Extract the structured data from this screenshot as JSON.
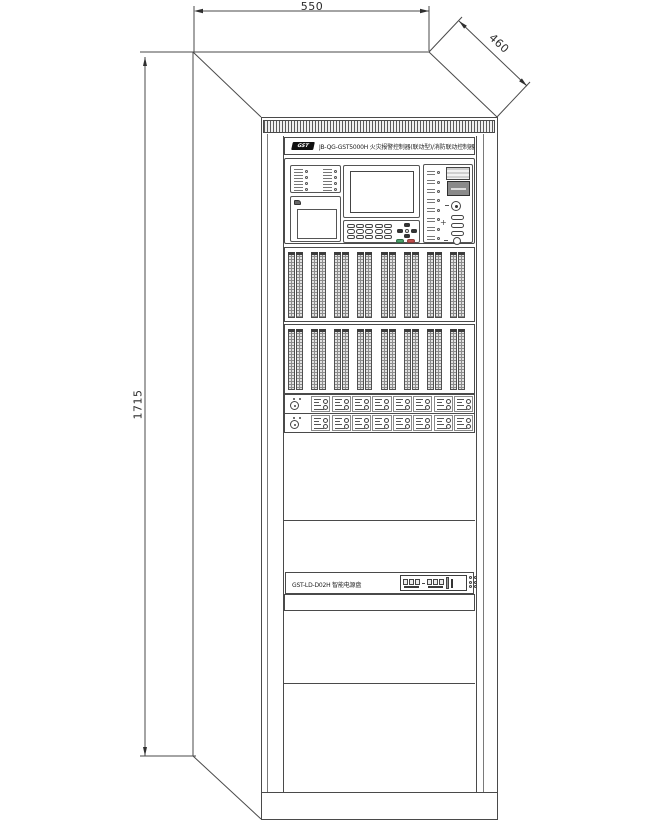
{
  "dimensions": {
    "top_width": "550",
    "side_depth": "460",
    "height": "1715"
  },
  "header": {
    "logo": "GST",
    "title": "JB-QG-GST5000H 火灾报警控制器(联动型)/消防联动控制器"
  },
  "power": {
    "label": "GST-LD-D02H 智能电源盘"
  },
  "counts": {
    "bank_columns": 8,
    "led_rows": 4,
    "right_leds": 8,
    "keypad_keys": 15,
    "small_modules": 8
  },
  "colors": {
    "line": "#4a4a4a",
    "dark": "#333333",
    "key_green": "#4a9f6a",
    "key_red": "#c0504d"
  }
}
